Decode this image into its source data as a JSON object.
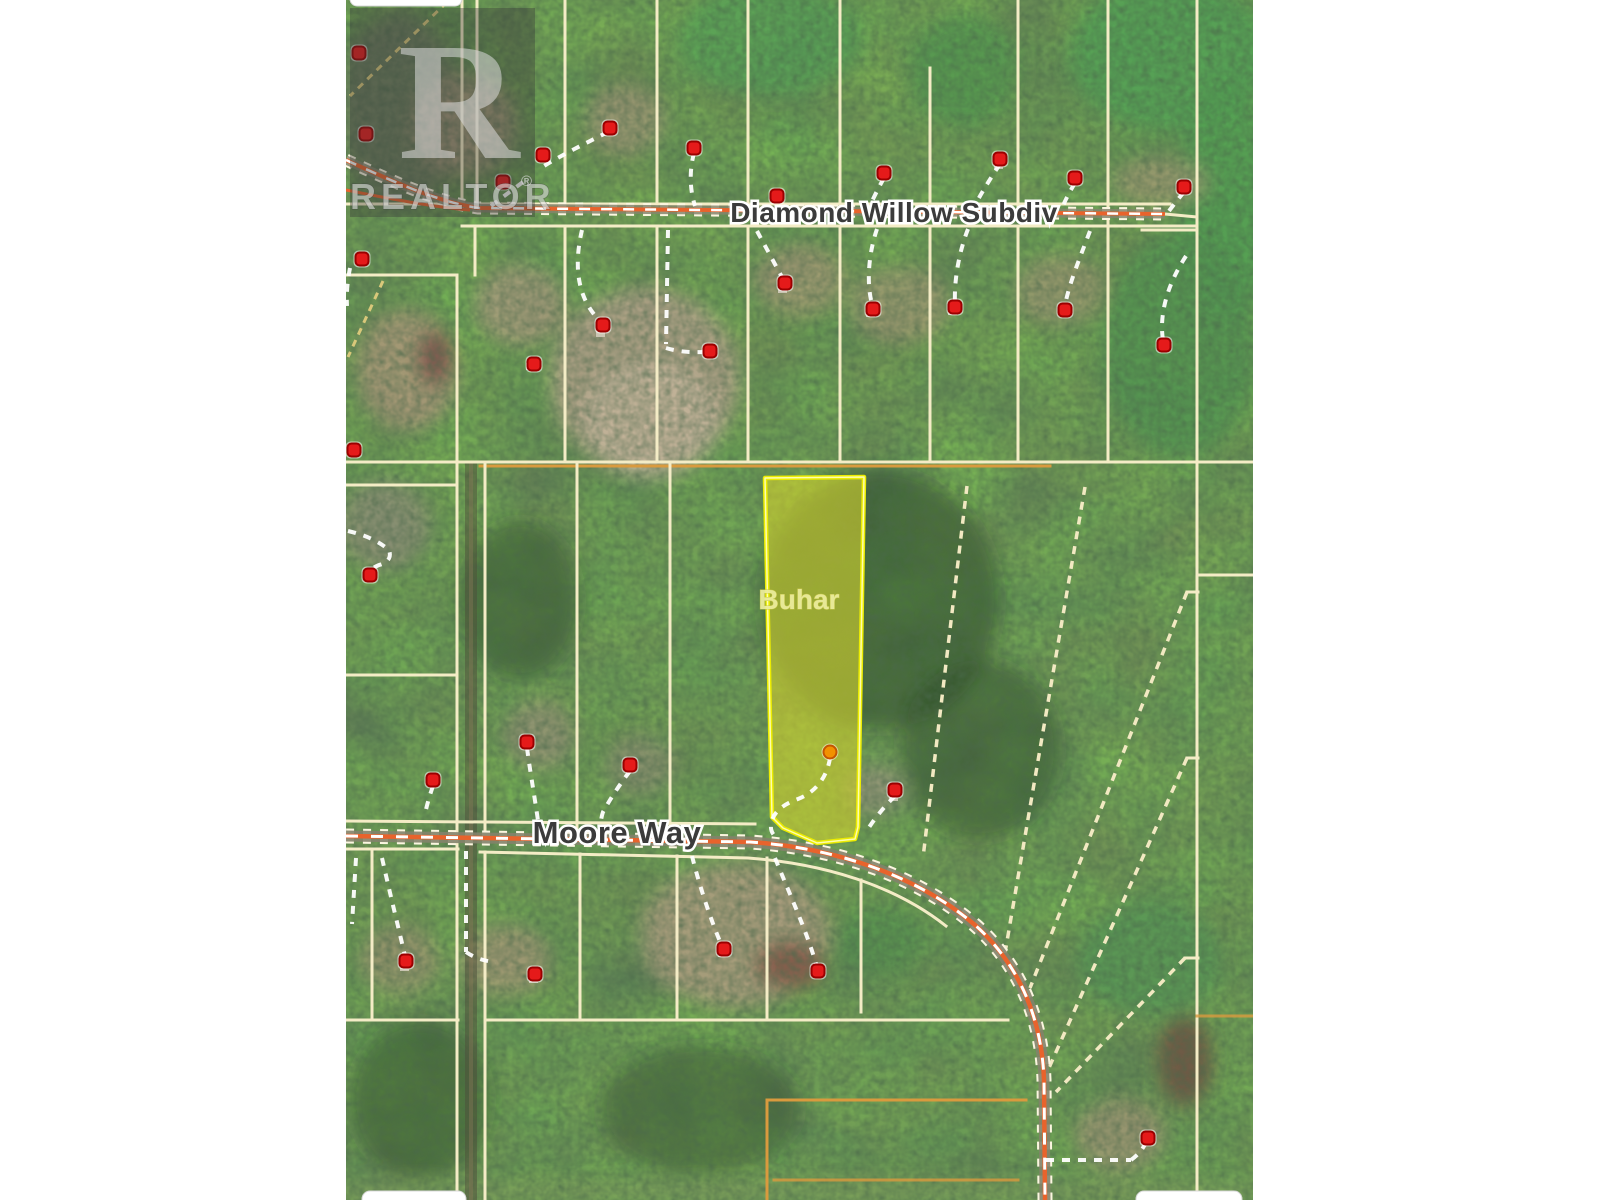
{
  "map": {
    "labels": {
      "road_top": {
        "text": "Diamond Willow Subdiv",
        "x": 894,
        "y": 222,
        "size": 28
      },
      "road_bottom": {
        "text": "Moore Way",
        "x": 617,
        "y": 843,
        "size": 31
      },
      "highlight": {
        "text": "Buhar",
        "x": 799,
        "y": 609,
        "size": 28
      }
    },
    "watermark": {
      "letter": "R",
      "word": "REALTOR",
      "reg": "®"
    },
    "markers": {
      "red": [
        [
          359,
          53
        ],
        [
          366,
          134
        ],
        [
          610,
          128
        ],
        [
          543,
          155
        ],
        [
          503,
          182
        ],
        [
          694,
          148
        ],
        [
          777,
          196
        ],
        [
          884,
          173
        ],
        [
          1000,
          159
        ],
        [
          1075,
          178
        ],
        [
          1184,
          187
        ],
        [
          362,
          259
        ],
        [
          354,
          450
        ],
        [
          603,
          325
        ],
        [
          534,
          364
        ],
        [
          710,
          351
        ],
        [
          785,
          283
        ],
        [
          873,
          309
        ],
        [
          955,
          307
        ],
        [
          1065,
          310
        ],
        [
          1164,
          345
        ],
        [
          370,
          575
        ],
        [
          433,
          780
        ],
        [
          527,
          742
        ],
        [
          630,
          765
        ],
        [
          895,
          790
        ],
        [
          406,
          961
        ],
        [
          535,
          974
        ],
        [
          724,
          949
        ],
        [
          818,
          971
        ],
        [
          1148,
          1138
        ]
      ],
      "orange": [
        [
          830,
          752
        ]
      ]
    },
    "colors": {
      "forest": "#3b5a36",
      "field_green": "#55a055",
      "clearing_tan": "#ab9b7e",
      "parcel_line": "#f4ecc6",
      "parcel_line_orange": "#d99a3e",
      "road_orange": "#e8632c",
      "road_dash": "#ffffff",
      "highlight_fill": "#cfcf2e",
      "highlight_stroke": "#ecec00",
      "marker_red": "#e51a1a",
      "marker_ring": "#9b0000",
      "marker_orange": "#f29100",
      "label_fill": "#3b3b3b",
      "label_halo": "#ffffff",
      "highlight_label": "#ecec9c"
    }
  }
}
